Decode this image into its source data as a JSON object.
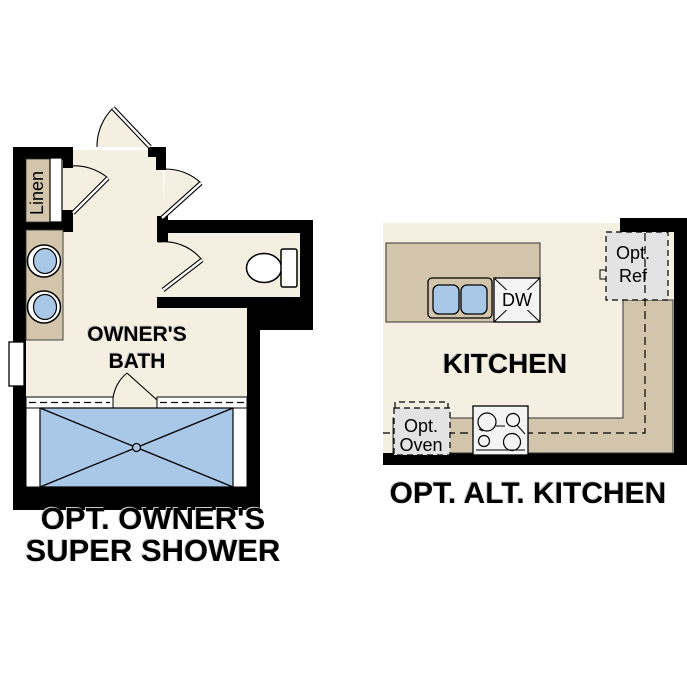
{
  "page": {
    "background": "#ffffff"
  },
  "colors": {
    "page": "#ffffff",
    "floor": "#f5efe2",
    "cabinet": "#d2c5ab",
    "water": "#a9c8e8",
    "wall": "#000000",
    "appliance": "#e3e3e3",
    "range": "#f4f4f4",
    "line": "#1a1a1a"
  },
  "bath_plan": {
    "title_line1": "OPT. OWNER'S",
    "title_line2": "SUPER SHOWER",
    "room_label_line1": "OWNER'S",
    "room_label_line2": "BATH",
    "linen_label": "Linen"
  },
  "kitchen_plan": {
    "title": "OPT. ALT. KITCHEN",
    "room_label": "KITCHEN",
    "dishwasher_label": "DW",
    "fridge_label_line1": "Opt.",
    "fridge_label_line2": "Ref",
    "oven_label_line1": "Opt.",
    "oven_label_line2": "Oven"
  }
}
